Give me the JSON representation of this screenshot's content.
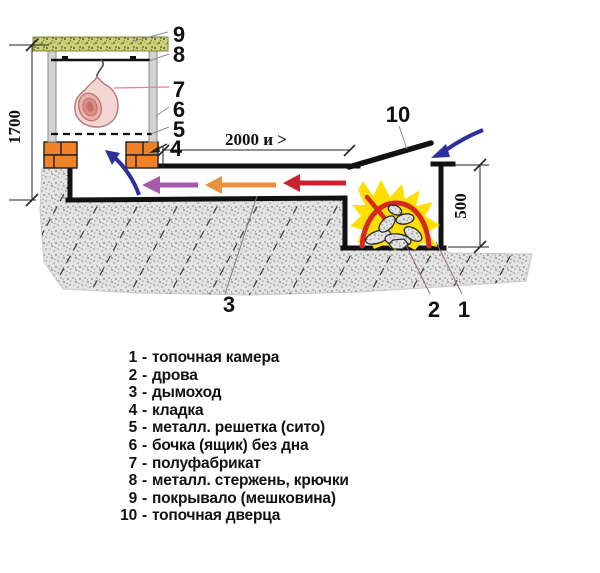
{
  "diagram": {
    "dimensions": {
      "height": "1700",
      "length": "2000 и >",
      "firebox_depth": "500"
    },
    "callouts": {
      "c1": "1",
      "c2": "2",
      "c3": "3",
      "c4": "4",
      "c5": "5",
      "c6": "6",
      "c7": "7",
      "c8": "8",
      "c9": "9",
      "c10": "10"
    },
    "colors": {
      "brick": "#f28227",
      "flame_yellow": "#ffdf00",
      "flame_red": "#d5281e",
      "smoke_hot_arrow": "#c8232f",
      "smoke_warm_arrow": "#e89140",
      "smoke_cool_arrow": "#a55aab",
      "airflow_arrow": "#2c2f9c",
      "cover_green": "#cdd179",
      "meat_pink": "#f3d6d2"
    }
  },
  "legend": {
    "dash": "-",
    "items": [
      {
        "num": "1",
        "label": "топочная камера"
      },
      {
        "num": "2",
        "label": "дрова"
      },
      {
        "num": "3",
        "label": "дымоход"
      },
      {
        "num": "4",
        "label": "кладка"
      },
      {
        "num": "5",
        "label": "металл. решетка (сито)"
      },
      {
        "num": "6",
        "label": "бочка (ящик) без дна"
      },
      {
        "num": "7",
        "label": "полуфабрикат"
      },
      {
        "num": "8",
        "label": "металл. стержень, крючки"
      },
      {
        "num": "9",
        "label": "покрывало (мешковина)"
      },
      {
        "num": "10",
        "label": "топочная дверца"
      }
    ]
  }
}
